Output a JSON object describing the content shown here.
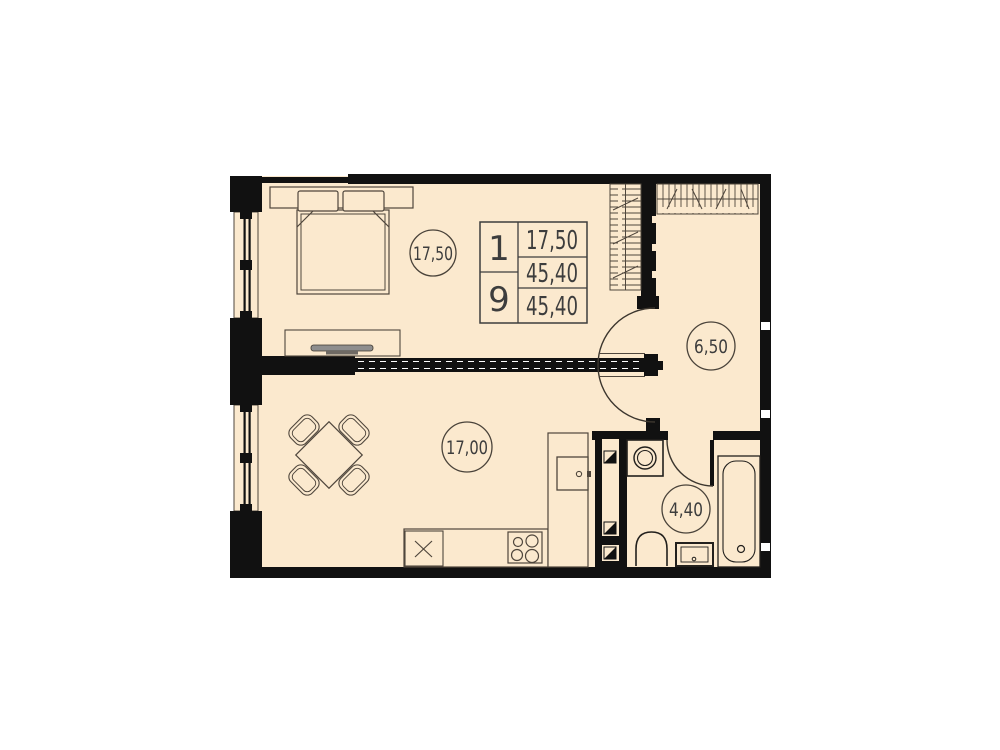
{
  "plan": {
    "type": "apartment-floor-plan",
    "rooms": [
      {
        "id": "bedroom",
        "area_label": "17,50"
      },
      {
        "id": "living-kitchen",
        "area_label": "17,00"
      },
      {
        "id": "hallway",
        "area_label": "6,50"
      },
      {
        "id": "bathroom",
        "area_label": "4,40"
      }
    ],
    "info_table": {
      "rooms_count": "1",
      "unit_number": "9",
      "living_area": "17,50",
      "area": "45,40",
      "total_area": "45,40"
    },
    "colors": {
      "floor": "#fbe9ce",
      "walls": "#111111",
      "furniture_lines": "#4f463c",
      "text": "#3d3d3d",
      "tv": "#8e8e8e"
    }
  }
}
